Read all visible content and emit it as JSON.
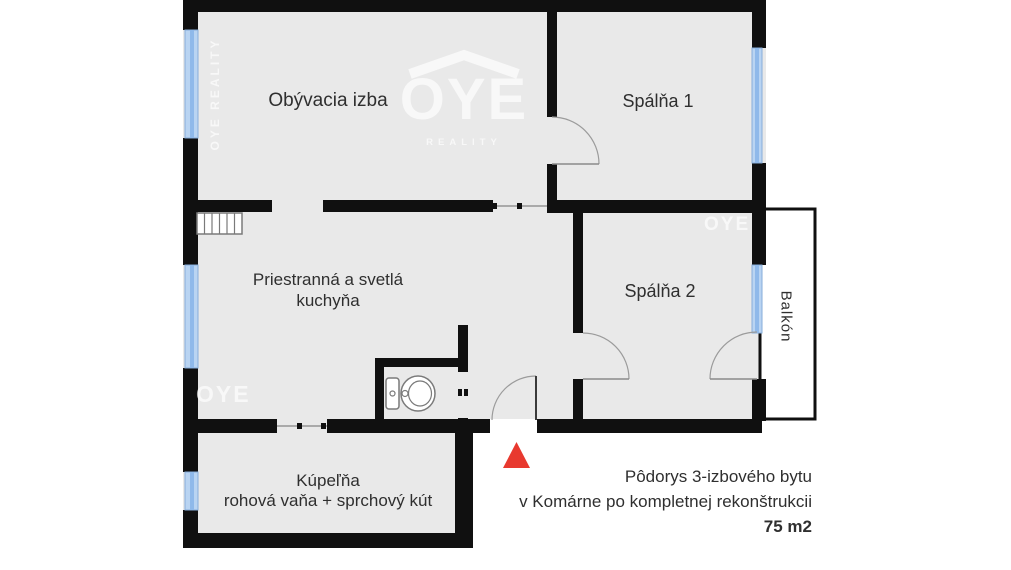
{
  "rooms": {
    "living": {
      "label": "Obývacia izba"
    },
    "bedroom1": {
      "label": "Spálňa 1"
    },
    "kitchen": {
      "line1": "Priestranná a svetlá",
      "line2": "kuchyňa"
    },
    "bedroom2": {
      "label": "Spálňa 2"
    },
    "balcony": {
      "label": "Balkón"
    },
    "bathroom": {
      "line1": "Kúpeľňa",
      "line2": "rohová vaňa + sprchový kút"
    }
  },
  "caption": {
    "line1": "Pôdorys 3-izbového bytu",
    "line2": "v Komárne po kompletnej rekonštrukcii",
    "area": "75 m2"
  },
  "watermarks": {
    "side": "OYE REALITY",
    "logo": "OYE",
    "logo_sub": "REALITY",
    "kitchen": "OYE",
    "bedroom2": "OYE"
  },
  "colors": {
    "wall": "#101010",
    "floor": "#e9e9e9",
    "window_fill": "#b9d4f2",
    "window_band": "#8fb9ea",
    "window_edge": "#86add9",
    "door_arc": "#9b9b9b",
    "door_leaf": "#8a8a8a",
    "fixture_stroke": "#7a7a7a",
    "entrance_marker": "#e8392f",
    "label_text": "#2f2f2f",
    "watermark": "rgba(255,255,255,0.68)"
  }
}
